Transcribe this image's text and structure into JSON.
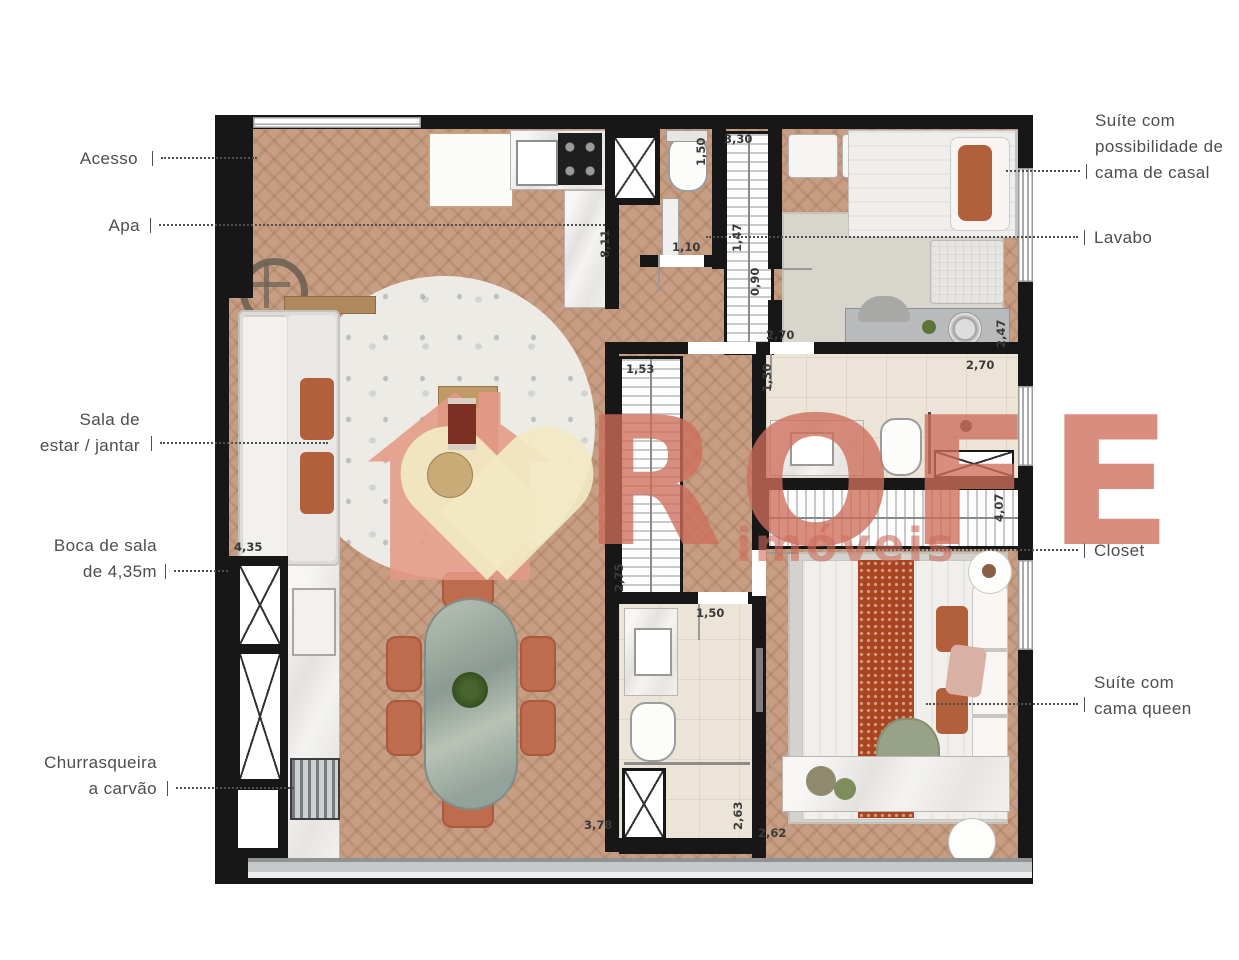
{
  "watermark": {
    "title": "ROFE",
    "subtitle": "imóveis"
  },
  "callouts": {
    "left": [
      {
        "id": "acesso",
        "text": "Acesso"
      },
      {
        "id": "apa",
        "text": "Apa"
      },
      {
        "id": "sala",
        "text": "Sala de\nestar / jantar"
      },
      {
        "id": "boca",
        "text": "Boca de sala\nde 4,35m"
      },
      {
        "id": "churrasqueira",
        "text": "Churrasqueira\na carvão"
      }
    ],
    "right": [
      {
        "id": "suite-casal",
        "text": "Suíte com\npossibilidade de\ncama de casal"
      },
      {
        "id": "lavabo",
        "text": "Lavabo"
      },
      {
        "id": "closet",
        "text": "Closet"
      },
      {
        "id": "suite-queen",
        "text": "Suíte com\ncama queen"
      }
    ]
  },
  "dimensions": [
    {
      "text": "1,50"
    },
    {
      "text": "3,30"
    },
    {
      "text": "8,11"
    },
    {
      "text": "1,47"
    },
    {
      "text": "1,10"
    },
    {
      "text": "0,90"
    },
    {
      "text": "2,70"
    },
    {
      "text": "2,47"
    },
    {
      "text": "2,70"
    },
    {
      "text": "1,53"
    },
    {
      "text": "1,30"
    },
    {
      "text": "4,07"
    },
    {
      "text": "2,75"
    },
    {
      "text": "4,35"
    },
    {
      "text": "1,50"
    },
    {
      "text": "2,63"
    },
    {
      "text": "3,78"
    },
    {
      "text": "2,62"
    }
  ],
  "colors": {
    "wall": "#171717",
    "wood_floor": "#c79e83",
    "tile_floor": "#ece4d6",
    "terracotta": "#bf6b4e",
    "runner_orange": "#a8441f",
    "watermark_salmon": "#cd6d5b",
    "logo_pink": "#e49886",
    "logo_cream": "#f2e9c4",
    "sage_green": "#97a287"
  }
}
